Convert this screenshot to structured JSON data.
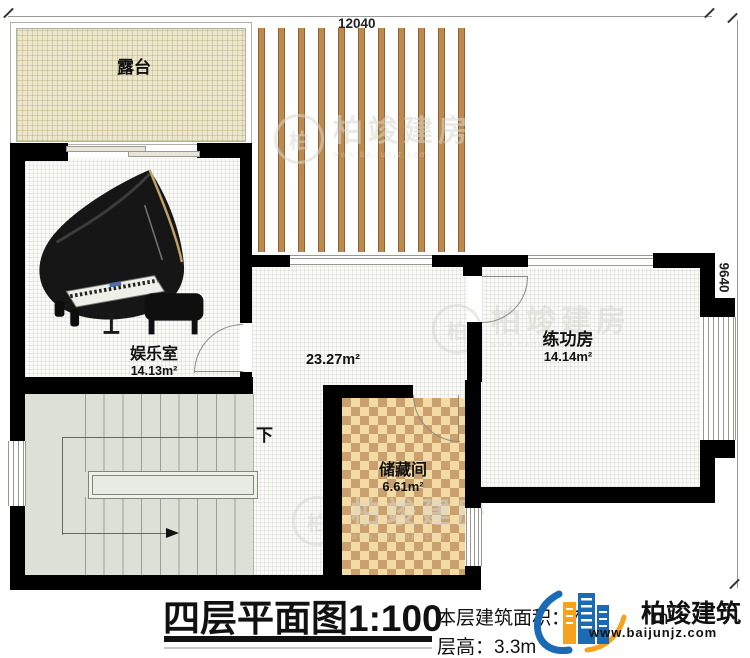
{
  "plan": {
    "dimensions": {
      "width_mm": "12040",
      "height_mm": "9640"
    },
    "rooms": {
      "terrace": {
        "name": "露台"
      },
      "entertainment": {
        "name": "娱乐室",
        "area": "14.13m²"
      },
      "hall": {
        "area": "23.27m²"
      },
      "practice": {
        "name": "练功房",
        "area": "14.14m²"
      },
      "storage": {
        "name": "储藏间",
        "area": "6.61m²"
      }
    },
    "stairs": {
      "down_label": "下"
    }
  },
  "title_block": {
    "title": "四层平面图",
    "scale": "1:100",
    "floor_area_label": "本层建筑面积：",
    "floor_area_visible_value": "7",
    "floor_area_unit": "m²",
    "floor_height_label": "层高：",
    "floor_height_value": "3.3m"
  },
  "brand": {
    "name": "柏竣建筑",
    "website": "www.baijunjz.com",
    "watermark_text": "柏竣建房",
    "watermark_char": "柏",
    "watermark_subtext": "www.baijunjz.com"
  },
  "colors": {
    "wall": "#000000",
    "wood_slat": "#bd8a4e",
    "stair": "#dce1d7",
    "checker_light": "#f2dba4",
    "checker_dark": "#c9a06e",
    "logo_blue": "#1b6ab5",
    "logo_orange": "#f6a21c"
  }
}
